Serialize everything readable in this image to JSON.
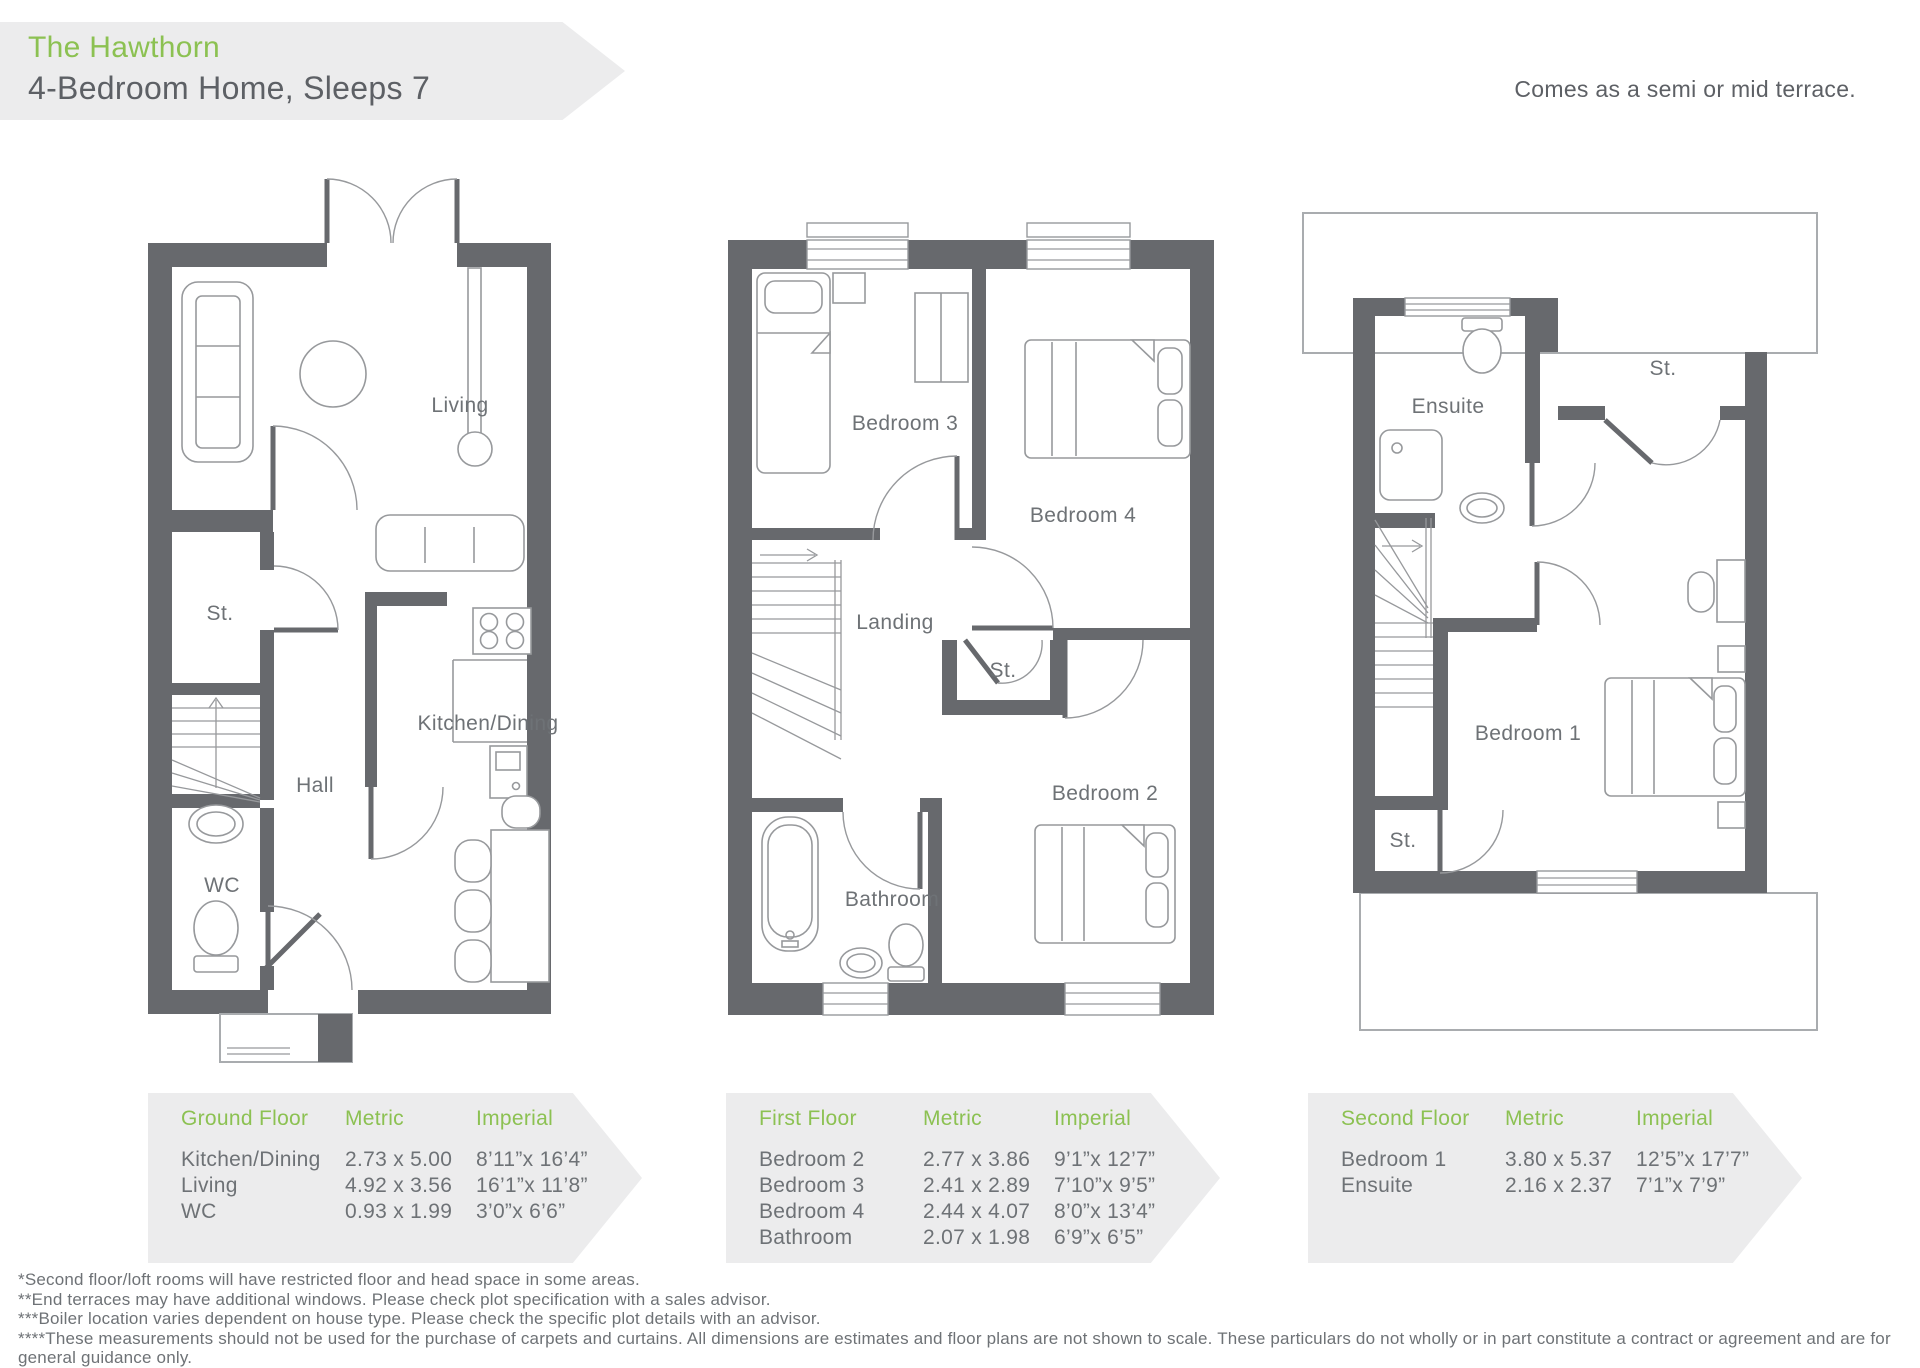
{
  "header": {
    "title": "The Hawthorn",
    "subtitle": "4-Bedroom Home, Sleeps 7",
    "terrace_note": "Comes as a semi or mid terrace."
  },
  "plans": {
    "ground": {
      "living": "Living",
      "storage": "St.",
      "hall": "Hall",
      "wc": "WC",
      "kitchen_dining": "Kitchen/Dining"
    },
    "first": {
      "bedroom3": "Bedroom 3",
      "bedroom4": "Bedroom 4",
      "landing": "Landing",
      "storage": "St.",
      "bedroom2": "Bedroom 2",
      "bathroom": "Bathroom"
    },
    "second": {
      "ensuite": "Ensuite",
      "storage_top": "St.",
      "bedroom1": "Bedroom 1",
      "storage_bottom": "St."
    }
  },
  "tables": [
    {
      "title": "Ground Floor",
      "metric_header": "Metric",
      "imperial_header": "Imperial",
      "rows": [
        {
          "room": "Kitchen/Dining",
          "metric": "2.73 x 5.00",
          "imperial": "8’11”x 16’4”"
        },
        {
          "room": "Living",
          "metric": "4.92 x 3.56",
          "imperial": "16’1”x 11’8”"
        },
        {
          "room": "WC",
          "metric": "0.93 x 1.99",
          "imperial": "3’0”x 6’6”"
        }
      ]
    },
    {
      "title": "First Floor",
      "metric_header": "Metric",
      "imperial_header": "Imperial",
      "rows": [
        {
          "room": "Bedroom 2",
          "metric": "2.77 x 3.86",
          "imperial": "9’1”x 12’7”"
        },
        {
          "room": "Bedroom 3",
          "metric": "2.41 x 2.89",
          "imperial": "7’10”x 9’5”"
        },
        {
          "room": "Bedroom 4",
          "metric": "2.44 x 4.07",
          "imperial": "8’0”x 13’4”"
        },
        {
          "room": "Bathroom",
          "metric": "2.07 x 1.98",
          "imperial": "6’9”x 6’5”"
        }
      ]
    },
    {
      "title": "Second Floor",
      "metric_header": "Metric",
      "imperial_header": "Imperial",
      "rows": [
        {
          "room": "Bedroom 1",
          "metric": "3.80 x 5.37",
          "imperial": "12’5”x 17’7”"
        },
        {
          "room": "Ensuite",
          "metric": "2.16 x 2.37",
          "imperial": "7’1”x 7’9”"
        }
      ]
    }
  ],
  "footnotes": [
    "*Second floor/loft rooms will have restricted floor and head space in some areas.",
    "**End terraces may have additional windows. Please check plot specification with a sales advisor.",
    "***Boiler location varies dependent on house type. Please check the specific plot details with an advisor.",
    "****These measurements should not be used for the purchase of carpets and curtains. All dimensions are estimates and floor plans are not shown to scale. These particulars do not wholly or in part constitute a contract or agreement and are for general guidance only."
  ],
  "colors": {
    "accent_green": "#8cc152",
    "wall_gray": "#67696d",
    "text_gray": "#6e7276",
    "banner_gray": "#ececed",
    "furniture_line": "#97999c"
  }
}
